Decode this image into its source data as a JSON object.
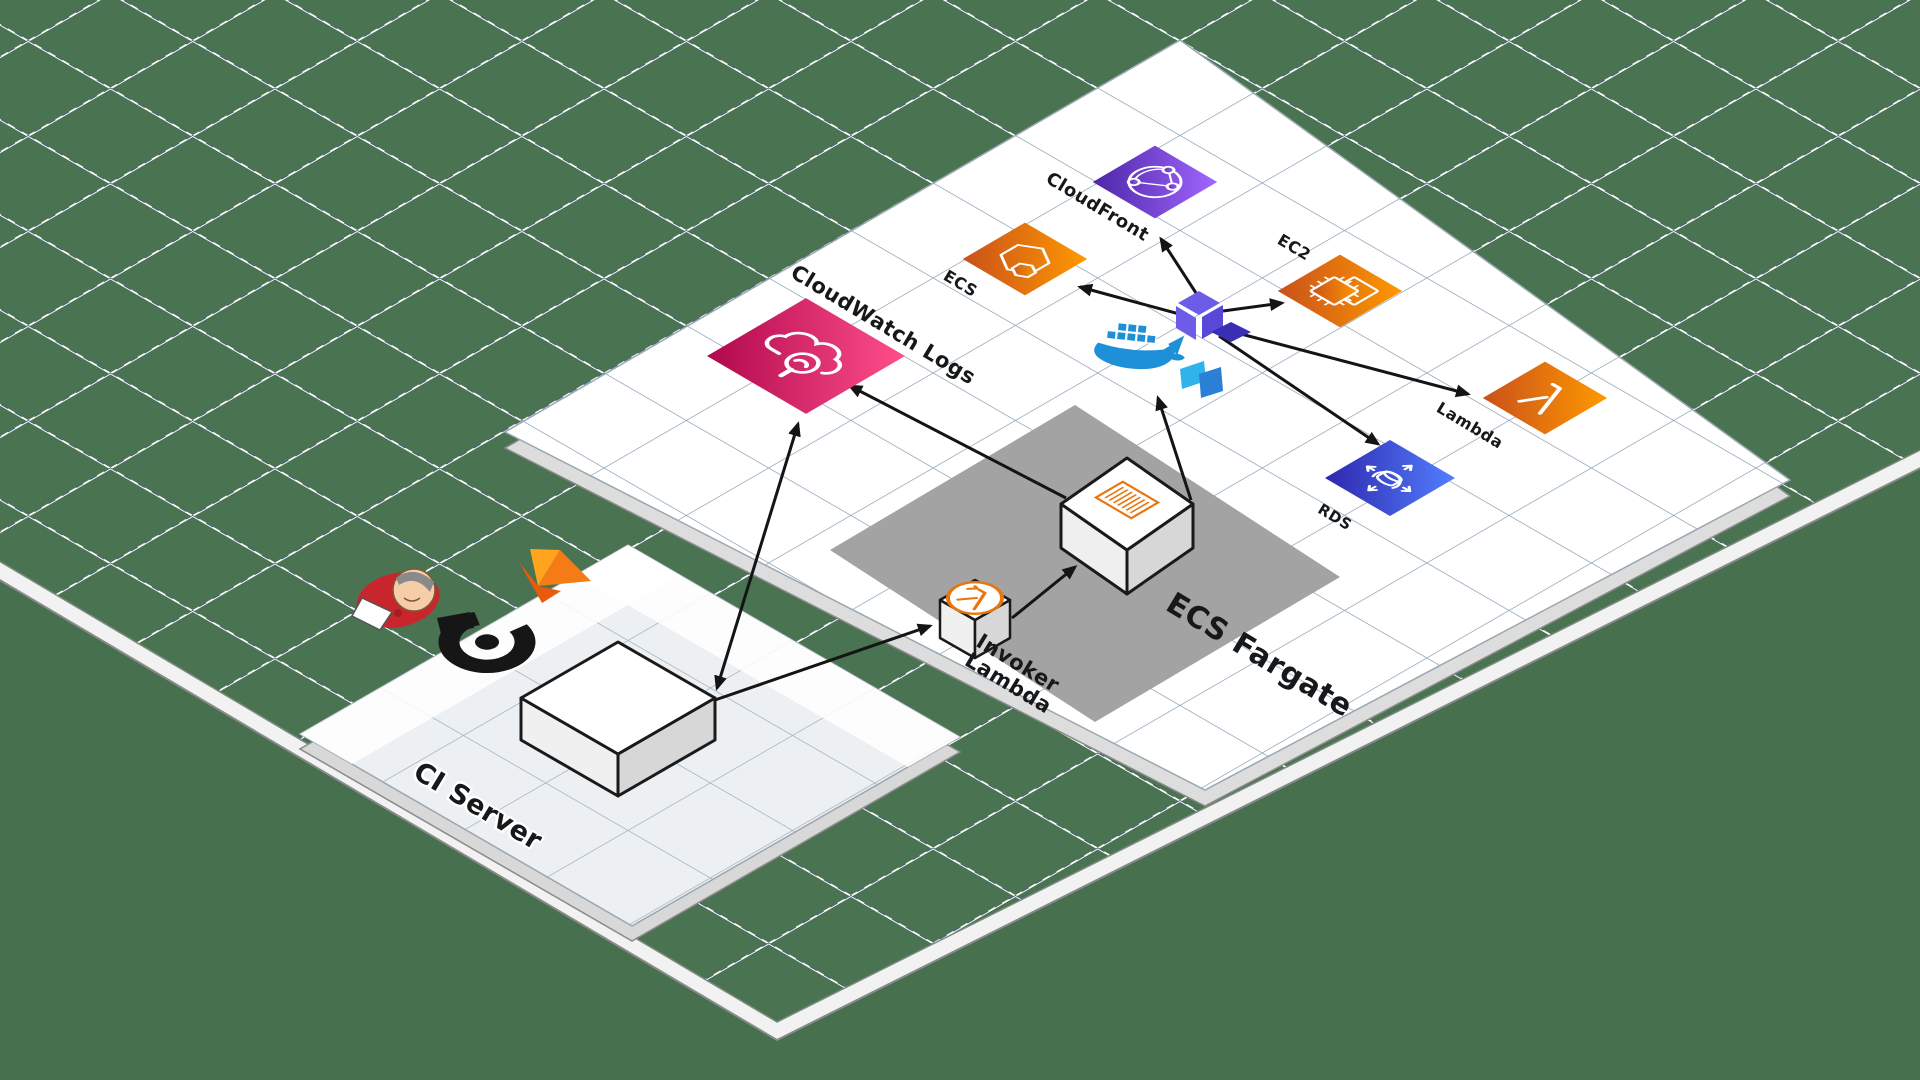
{
  "nodes": {
    "cloudfront": {
      "label": "CloudFront"
    },
    "ecs": {
      "label": "ECS"
    },
    "ec2": {
      "label": "EC2"
    },
    "lambda": {
      "label": "Lambda"
    },
    "rds": {
      "label": "RDS"
    },
    "cloudwatch_logs": {
      "label": "CloudWatch Logs"
    },
    "invoker_lambda": {
      "label_line1": "Invoker",
      "label_line2": "Lambda"
    },
    "ecs_fargate": {
      "label": "ECS Fargate"
    },
    "ci_server": {
      "label": "CI Server"
    }
  },
  "icons": {
    "cloudfront": "globe-network-icon",
    "ecs": "container-hexagon-icon",
    "ec2": "cpu-chip-icon",
    "lambda": "lambda-glyph-icon",
    "rds": "database-arrows-icon",
    "cloudwatch_logs": "cloud-magnifier-icon",
    "invoker_lambda": "lambda-circle-icon",
    "ecs_fargate_task": "document-hatch-icon",
    "ci_logos": [
      "jenkins-mascot-icon",
      "flame-logo-icon",
      "b-ring-logo-icon"
    ],
    "cluster_logos": [
      "docker-whale-icon",
      "terraform-logo-icon",
      "packer-logo-icon"
    ]
  },
  "colors": {
    "background": "#47704E",
    "grid_green": "#4A7351",
    "grid_line_white": "#FFFFFF",
    "grid_line_dashed": "#44518C",
    "platform_white": "#FFFFFF",
    "platform_grid_line": "#8FA5B8",
    "fargate_zone_gray": "#A3A3A3",
    "aws_orange_dark": "#C8511B",
    "aws_orange": "#FF9900",
    "purple_dark": "#4D27A8",
    "purple": "#A166FF",
    "pink_dark": "#B0084D",
    "pink": "#FF4F8B",
    "blue_dark": "#2E27AD",
    "blue": "#527FFF",
    "docker_blue": "#1D90D8",
    "terraform_purple": "#6C5CE8",
    "terraform_dark": "#3A2FB4",
    "packer_light": "#2FB3EA",
    "packer_blue": "#2B7FD4",
    "arrow": "#141414"
  },
  "connections": [
    {
      "from": "ci-server",
      "to": "cloudwatch-logs",
      "bidirectional": true
    },
    {
      "from": "ci-server",
      "to": "invoker-lambda",
      "bidirectional": false
    },
    {
      "from": "invoker-lambda",
      "to": "ecs-fargate",
      "bidirectional": false
    },
    {
      "from": "ecs-fargate",
      "to": "cloudwatch-logs",
      "bidirectional": false
    },
    {
      "from": "ecs-fargate",
      "to": "docker-terraform-cluster",
      "bidirectional": false
    },
    {
      "from": "terraform",
      "to": "ecs",
      "bidirectional": false
    },
    {
      "from": "terraform",
      "to": "cloudfront",
      "bidirectional": false
    },
    {
      "from": "terraform",
      "to": "ec2",
      "bidirectional": false
    },
    {
      "from": "terraform",
      "to": "lambda",
      "bidirectional": false
    },
    {
      "from": "terraform",
      "to": "rds",
      "bidirectional": false
    }
  ]
}
